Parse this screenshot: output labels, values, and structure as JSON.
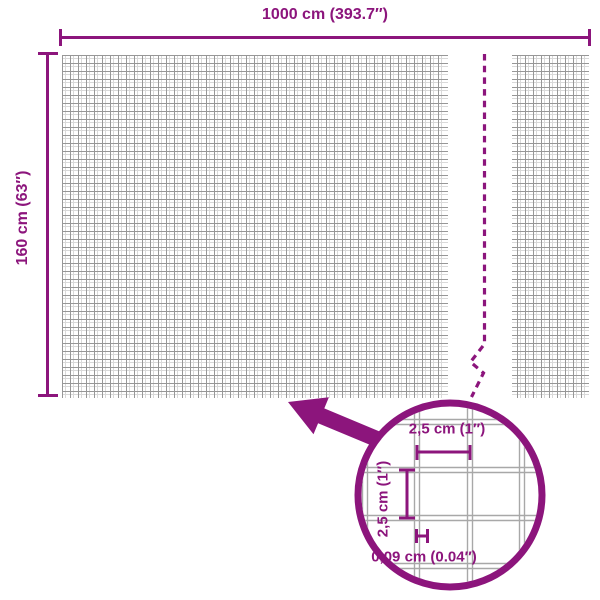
{
  "diagram": {
    "title": "wire mesh panel dimensions",
    "width_label": "1000 cm (393.7″)",
    "height_label": "160 cm (63″)",
    "detail": {
      "cell_width_label": "2,5 cm (1″)",
      "cell_height_label": "2,5 cm (1″)",
      "wire_thickness_label": "0,09 cm (0.04″)"
    },
    "colors": {
      "accent": "#8c157c",
      "mesh_dark": "#979797",
      "mesh_light": "#d9d9d9",
      "detail_wire": "#a8a8a8"
    }
  }
}
